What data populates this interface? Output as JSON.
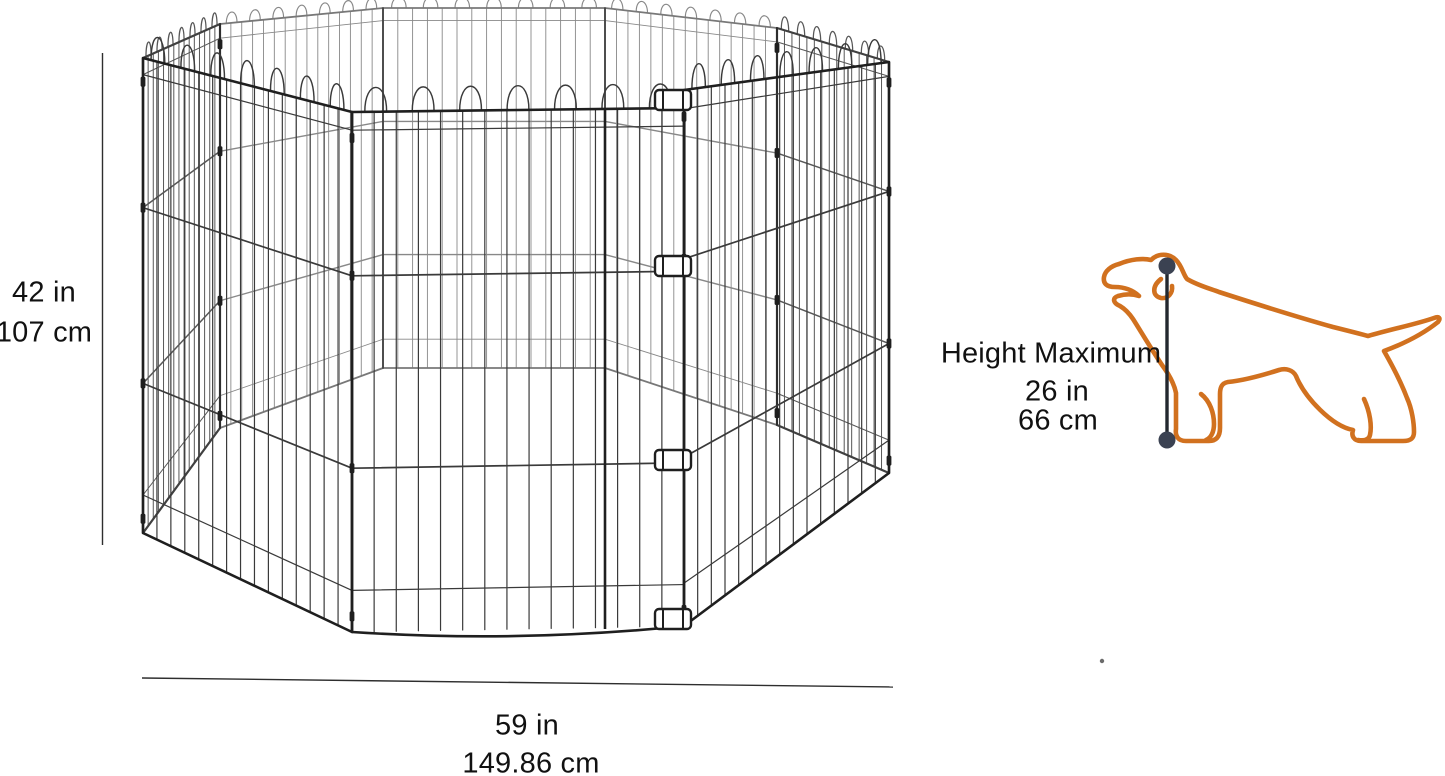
{
  "diagram": {
    "type": "product-dimension-diagram",
    "subject": "wire-exercise-playpen",
    "measurements": {
      "height": {
        "value_in": "42 in",
        "value_cm": "107 cm"
      },
      "width": {
        "value_in": "59 in",
        "value_cm": "149.86 cm"
      },
      "dog_height": {
        "title": "Height Maximum",
        "value_in": "26 in",
        "value_cm": "66 cm"
      }
    },
    "icons": {
      "pen": "wire-playpen-illustration",
      "dog": "dog-outline-icon",
      "height_marker": "measurement-line-with-end-dots"
    },
    "colors": {
      "background": "#ffffff",
      "text": "#111111",
      "wire": "#3a3a3a",
      "frame": "#1f1f1f",
      "dimension_line": "#2e2e2e",
      "dog_outline": "#d1711f",
      "marker_dot": "#3b4252",
      "marker_line": "#23282f"
    }
  }
}
